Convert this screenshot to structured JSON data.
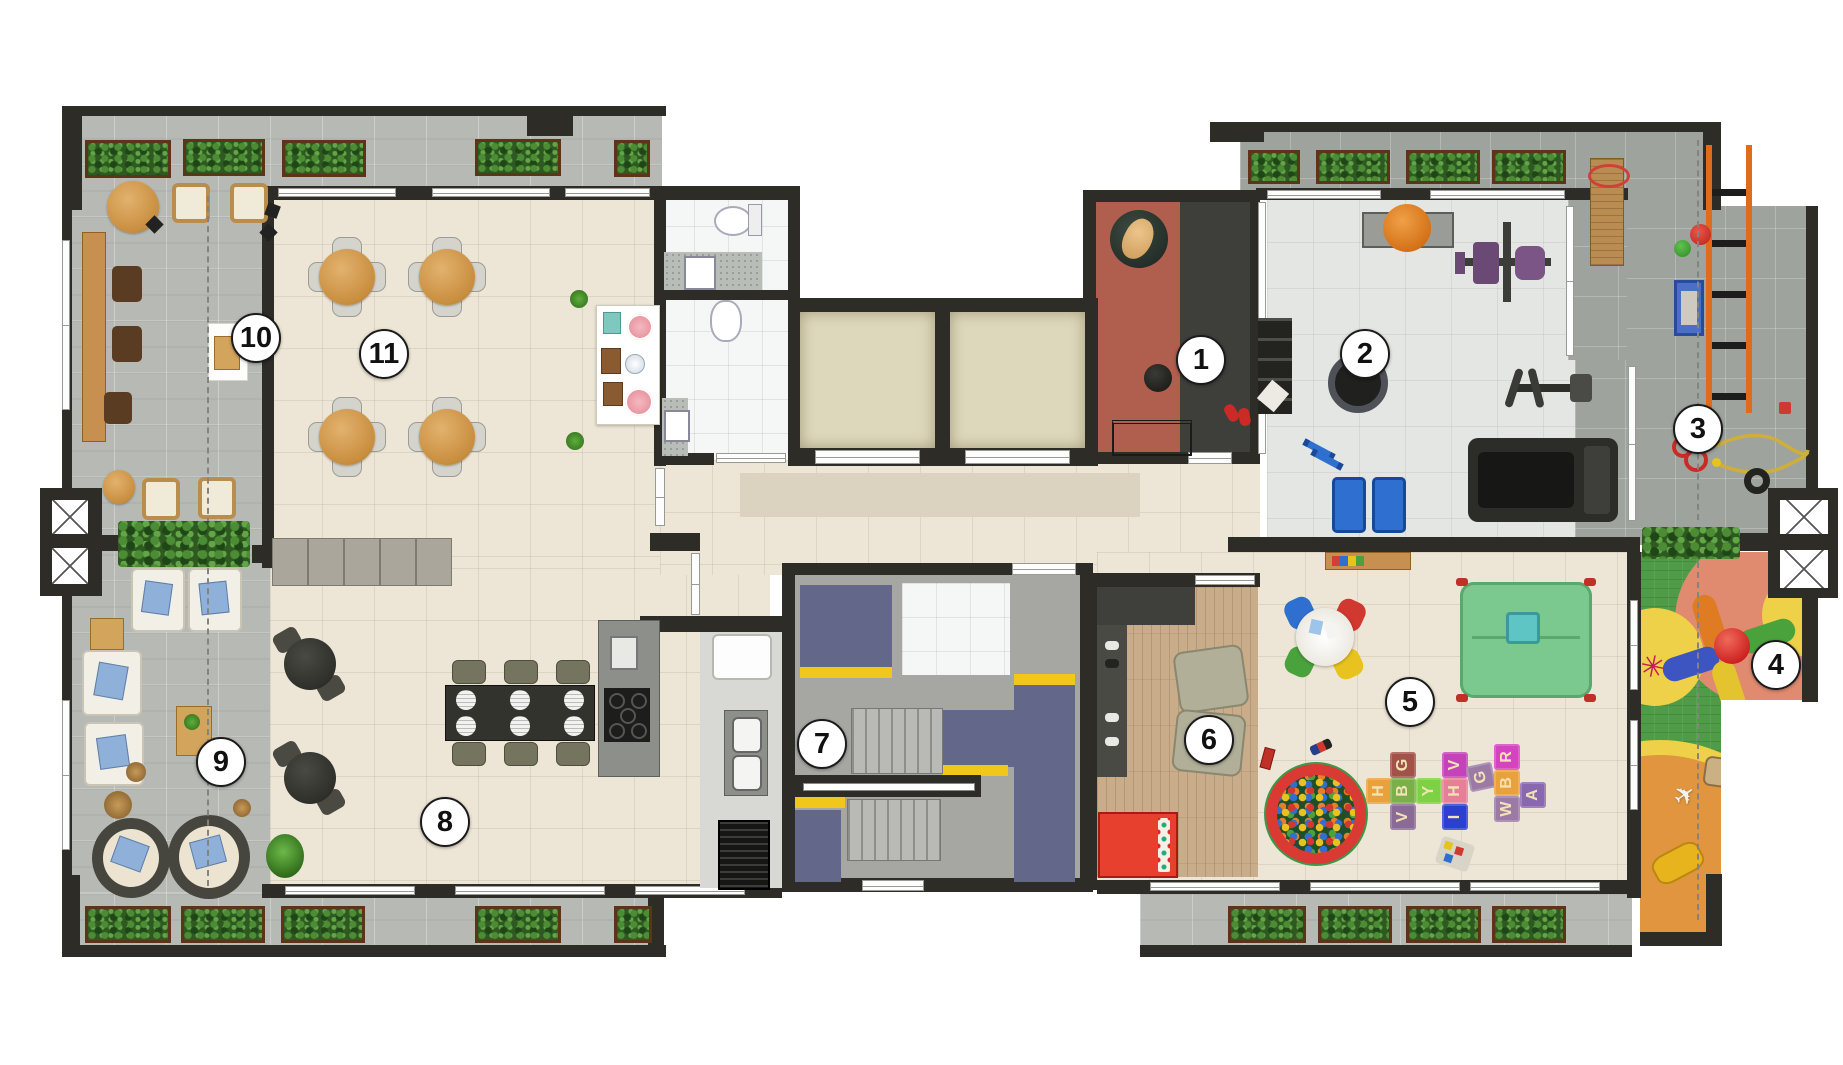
{
  "badges": [
    {
      "number": "1"
    },
    {
      "number": "2"
    },
    {
      "number": "3"
    },
    {
      "number": "4"
    },
    {
      "number": "5"
    },
    {
      "number": "6"
    },
    {
      "number": "7"
    },
    {
      "number": "8"
    },
    {
      "number": "9"
    },
    {
      "number": "10"
    },
    {
      "number": "11"
    }
  ],
  "mats": [
    {
      "letter": "H"
    },
    {
      "letter": "G"
    },
    {
      "letter": "B"
    },
    {
      "letter": "V"
    },
    {
      "letter": "Y"
    },
    {
      "letter": "V"
    },
    {
      "letter": "H"
    },
    {
      "letter": "I"
    },
    {
      "letter": "G"
    },
    {
      "letter": "R"
    },
    {
      "letter": "B"
    },
    {
      "letter": "W"
    },
    {
      "letter": "A"
    }
  ],
  "icons": {
    "spider": "✳",
    "plane": "✈"
  },
  "palette": {
    "wall": "#2d2c27",
    "terrace_light": "#b7bab4",
    "terrace_dark": "#9ea49d",
    "cream_floor": "#ede6d6",
    "gym_floor": "#e4e6e3",
    "wood_floor": "#c9ad8a",
    "stair_blue": "#63678a",
    "safety_yellow": "#f2c71c",
    "play_green": "#4f9b48",
    "play_salmon": "#e08a70",
    "play_yellow": "#eed049",
    "play_orange": "#e0953e",
    "room1_red": "#b05e4e",
    "room1_dark": "#3e3e3b",
    "elevator_cab": "#ddd7bb",
    "hedge_green": "#2e5a22",
    "ballpit_rim": "#d93a34",
    "bench_blue": "#2f6fd0",
    "machine_purple": "#6a4a74"
  }
}
